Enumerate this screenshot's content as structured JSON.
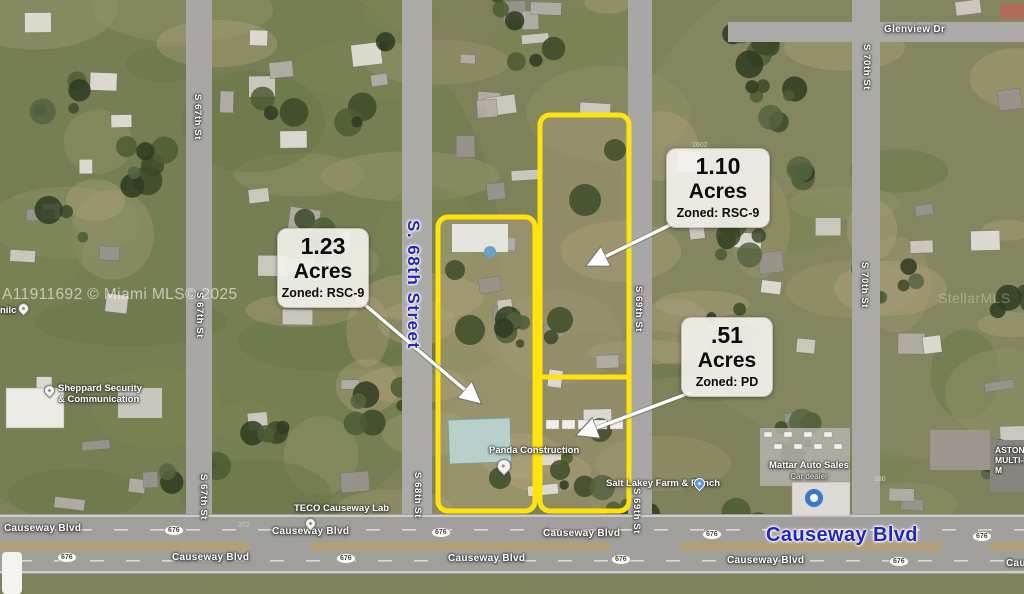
{
  "watermarks": {
    "listing": "A11911692 © Miami MLS© 2025",
    "right": "StellarMLS"
  },
  "callouts": [
    {
      "value": "1.23",
      "unit": "Acres",
      "zoning": "Zoned: RSC-9"
    },
    {
      "value": "1.10",
      "unit": "Acres",
      "zoning": "Zoned: RSC-9"
    },
    {
      "value": ".51",
      "unit": "Acres",
      "zoning": "Zoned: PD"
    }
  ],
  "streets": {
    "s67": "S 67th St",
    "s68_major": "S. 68th Street",
    "s68": "S 68th St",
    "s69": "S 69th St",
    "s70": "S 70th St",
    "glenview": "Glenview Dr",
    "causeway": "Causeway Blvd",
    "causeway_major": "Causeway Blvd",
    "route_676": "676"
  },
  "places": {
    "sheppard_line1": "Sheppard Security",
    "sheppard_line2": "& Communication",
    "panda": "Panda Construction",
    "salt_lakey": "Salt Lakey Farm & Ranch",
    "teco": "TECO Causeway Lab",
    "mattar": "Mattar Auto Sales",
    "mattar_type": "Car dealer",
    "edge_line1": "ASTON",
    "edge_line2": "MULTI-IRON",
    "edge_line3": "M",
    "left_fragment": "nilc"
  },
  "address_numbers": {
    "n1": "2602",
    "n2": "372",
    "n3": "380"
  },
  "colors": {
    "parcel_outline": "#ffe30a",
    "major_label_blue": "#2424c4"
  }
}
